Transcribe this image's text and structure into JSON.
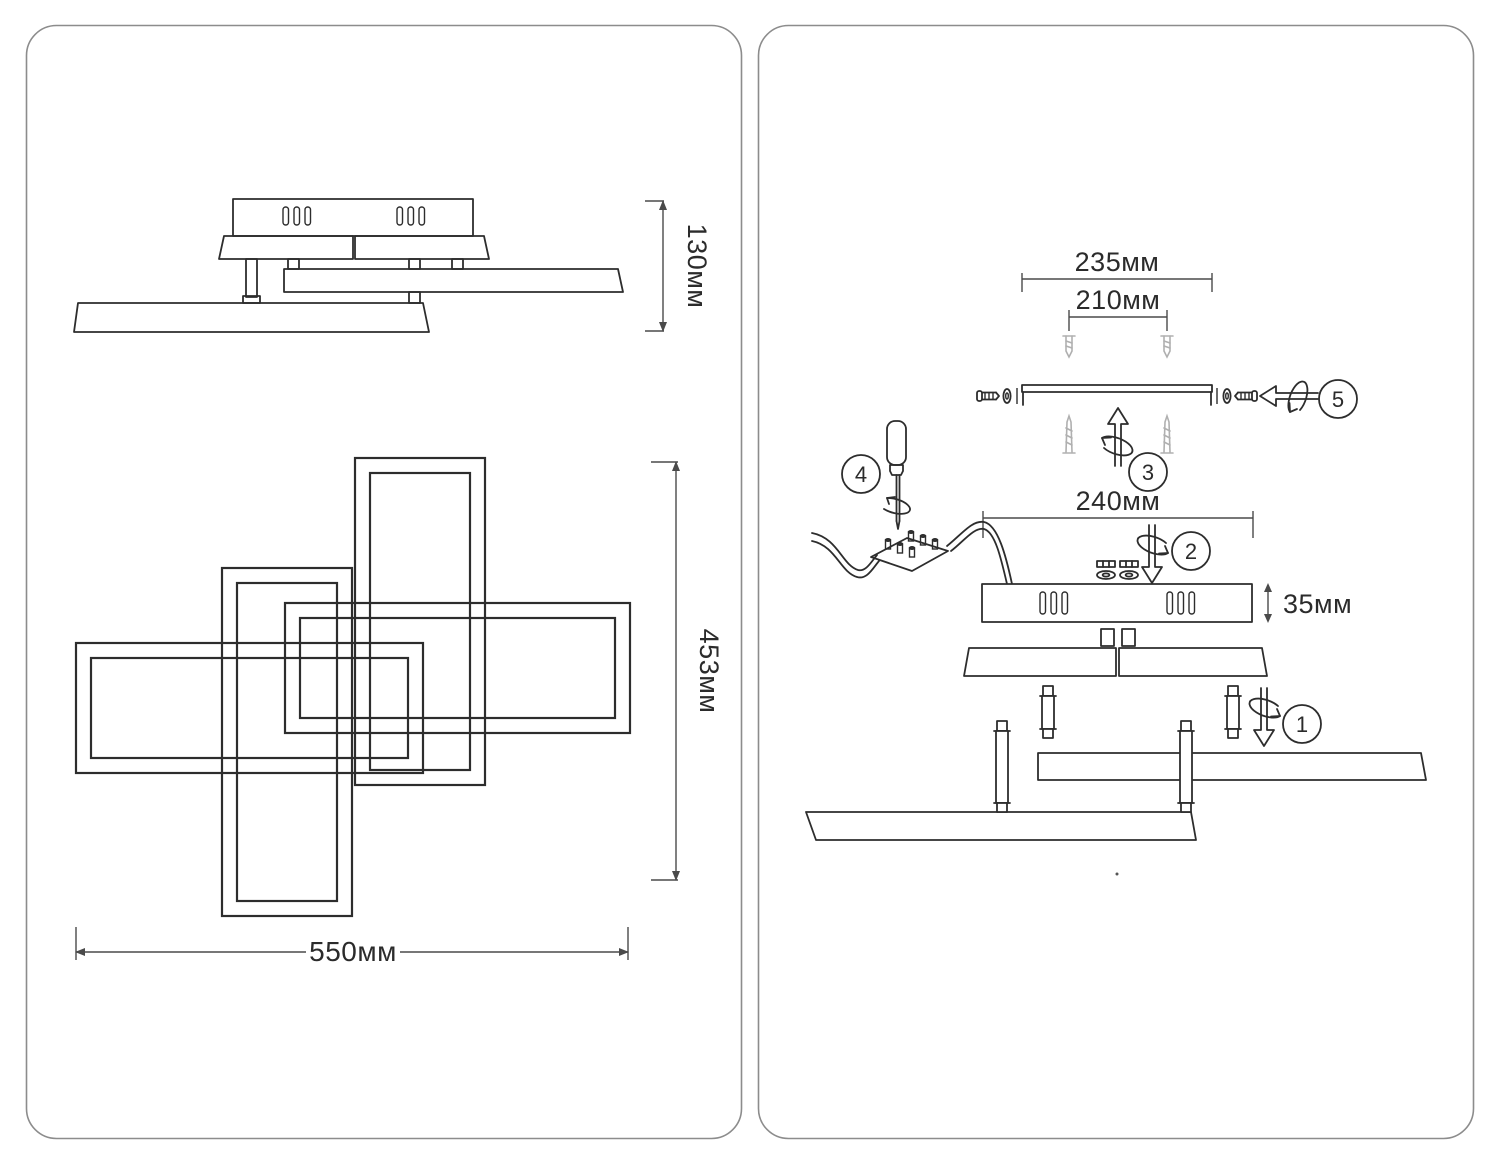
{
  "document": {
    "kind": "ceiling-light installation drawing, two framed panels",
    "colors": {
      "background": "#ffffff",
      "line": "#2d2d2d",
      "dimension_line": "#4a4a4a",
      "muted_parts": "#b0b0b0",
      "panel_border": "#8c8c8c"
    }
  },
  "left_panel": {
    "side_view": {
      "dim_height": "130мм"
    },
    "plan_view": {
      "dim_width": "550мм",
      "dim_height": "453мм"
    }
  },
  "right_panel": {
    "dim_bracket_width": "235мм",
    "dim_anchor_spacing": "210мм",
    "dim_canopy_width": "240мм",
    "dim_canopy_height": "35мм",
    "steps": [
      "1",
      "2",
      "3",
      "4",
      "5"
    ]
  },
  "icons": {
    "rotate-arrow-icon": "hollow arrow with spiral loop (screwing motion)",
    "wall-anchor-icon": "gray plastic dowel",
    "wood-screw-icon": "gray tapered screw",
    "machine-screw-icon": "screw with washer",
    "washer-icon": "ellipse ring",
    "nut-washer-icon": "nut stacked on washer",
    "screwdriver-icon": "screwdriver with rotation loop",
    "terminal-block-icon": "wire terminal block with six screws",
    "power-cable-icon": "wavy two-strand cable"
  }
}
